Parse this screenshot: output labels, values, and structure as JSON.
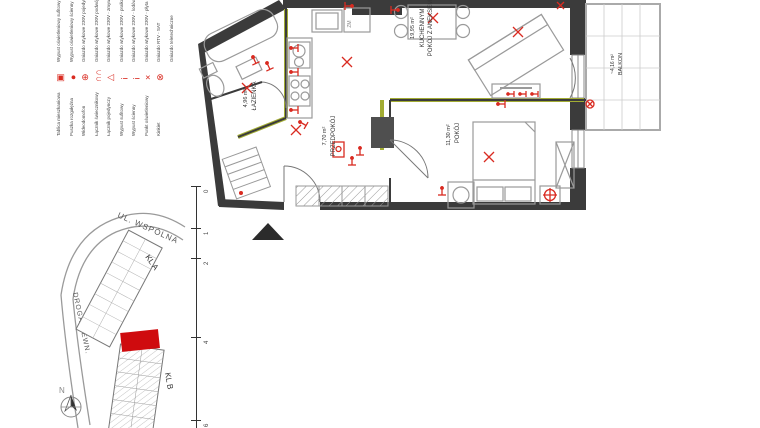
{
  "colors": {
    "accent_red": "#d92b21",
    "wall_black": "#3b3b3b",
    "highlight_olive": "#a2ac33",
    "unit_red": "#cf0b0e"
  },
  "legend": {
    "notes": [
      "Wypust oświetleniowy sufitowy",
      "Wypust oświetleniowy ścienny",
      "Gniazdo wtykowe 230V pojedyncze",
      "Gniazdo wtykowe 230V podwójne",
      "Gniazdo wtykowe 230V - zmywarka",
      "Gniazdo wtykowe 230V - pralka",
      "Gniazdo wtykowe 230V - lodówka",
      "Gniazdo wtykowe 230V - płyta kuchenna",
      "Gniazdo RTV - SAT",
      "Gniazdo teletechniczne"
    ],
    "entries": [
      {
        "glyph": "▣",
        "label": "Tablica mieszkaniowa"
      },
      {
        "glyph": "●",
        "label": "Puszka rozgałęźna"
      },
      {
        "glyph": "⊕",
        "label": "Wideodomofon"
      },
      {
        "glyph": "∩∩",
        "label": "Łącznik świecznikowy"
      },
      {
        "glyph": "△",
        "label": "Łącznik pojedynczy"
      },
      {
        "glyph": "¡",
        "label": "Wypust sufitowy"
      },
      {
        "glyph": "¡",
        "label": "Wypust ścienny"
      },
      {
        "glyph": "×",
        "label": "Punkt oświetleniowy"
      },
      {
        "glyph": "⊗",
        "label": "Kinkiet"
      }
    ]
  },
  "floorplan": {
    "rooms": [
      {
        "name": "ŁAZIENKA",
        "area": "4,96 m²"
      },
      {
        "name": "POKÓJ Z ANEKSEM",
        "name2": "KUCHENNYM",
        "area": "19,95 m²"
      },
      {
        "name": "PRZEDPOKÓJ",
        "area": "7,70 m²"
      },
      {
        "name": "POKÓJ",
        "area": "11,30 m²"
      },
      {
        "name": "BALKON",
        "area": "~4,16 m²"
      }
    ],
    "appliance_label": "ZM"
  },
  "scalebar": {
    "ticks": [
      "0",
      "1",
      "2",
      "4",
      "6"
    ]
  },
  "siteplan": {
    "street": "UL. WSPÓLNA",
    "road": "DROGA WEWN.",
    "stair_a": "KL A",
    "stair_b": "KL B",
    "north_label": "N"
  }
}
